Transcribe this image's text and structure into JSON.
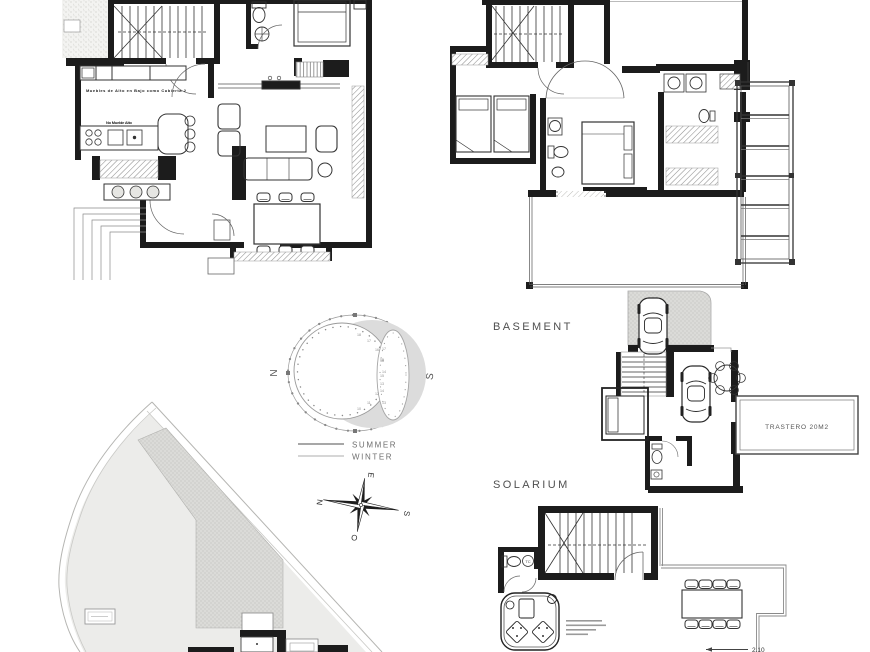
{
  "sheet": {
    "background": "#ffffff",
    "wall_color": "#1c1c1c",
    "hatch_gray": "#b8b8b4",
    "plot_gray": "#ececea"
  },
  "labels": {
    "basement": "BASEMENT",
    "solarium": "SOLARIUM"
  },
  "ground_floor": {
    "annotation_counter": "Muebles de Alto en Bajo como Cubierta 2",
    "annotation_kitchen": "No Mueble Alto"
  },
  "basement": {
    "storage_label": "TRASTERO 20M2"
  },
  "solarium": {
    "dimension": "2.10",
    "water_heater_label": "TC"
  },
  "sun_diagram": {
    "north": "N",
    "south": "S",
    "legend": [
      {
        "name": "summer",
        "label": "SUMMER",
        "color": "#8a8a8a"
      },
      {
        "name": "winter",
        "label": "WINTER",
        "color": "#bdbdbd"
      }
    ],
    "hours_summer": [
      "18",
      "17",
      "16",
      "15",
      "14",
      "13",
      "12",
      "11",
      "10"
    ],
    "hours_winter": [
      "17",
      "16",
      "15",
      "14",
      "13"
    ]
  },
  "compass": {
    "north": "N",
    "south": "S",
    "east": "E",
    "west": "O"
  }
}
